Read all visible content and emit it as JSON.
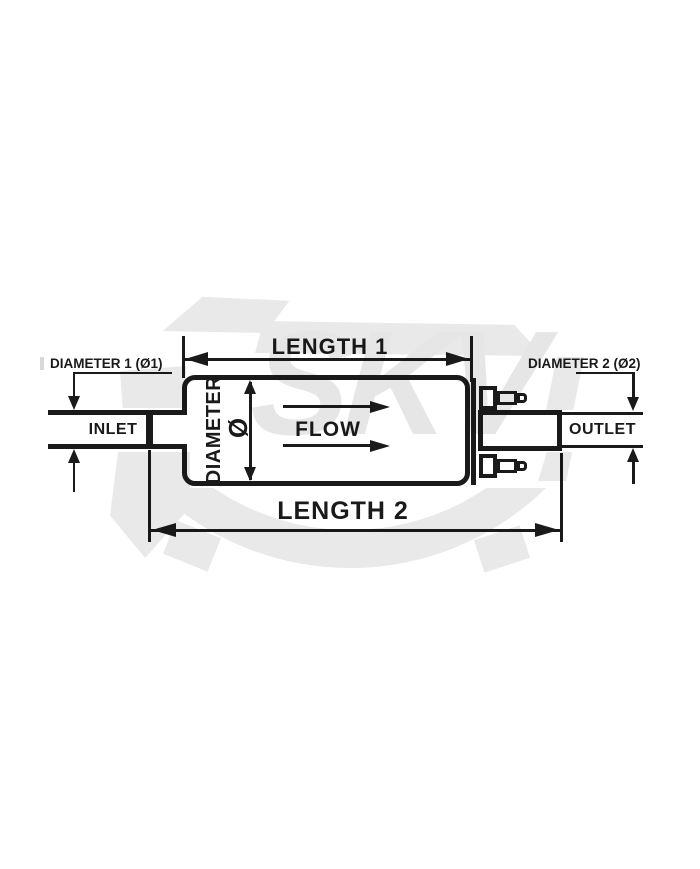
{
  "labels": {
    "length1": "LENGTH 1",
    "length2": "LENGTH 2",
    "diameter1": "DIAMETER 1 (Ø1)",
    "diameter2": "DIAMETER 2 (Ø2)",
    "diameter": "DIAMETER",
    "diameter_symbol": "Ø",
    "flow": "FLOW",
    "inlet": "INLET",
    "outlet": "OUTLET"
  },
  "watermark": {
    "text": "SKV"
  },
  "colors": {
    "line": "#1a1a1a",
    "watermark": "#e9e9e9",
    "background": "#ffffff"
  }
}
